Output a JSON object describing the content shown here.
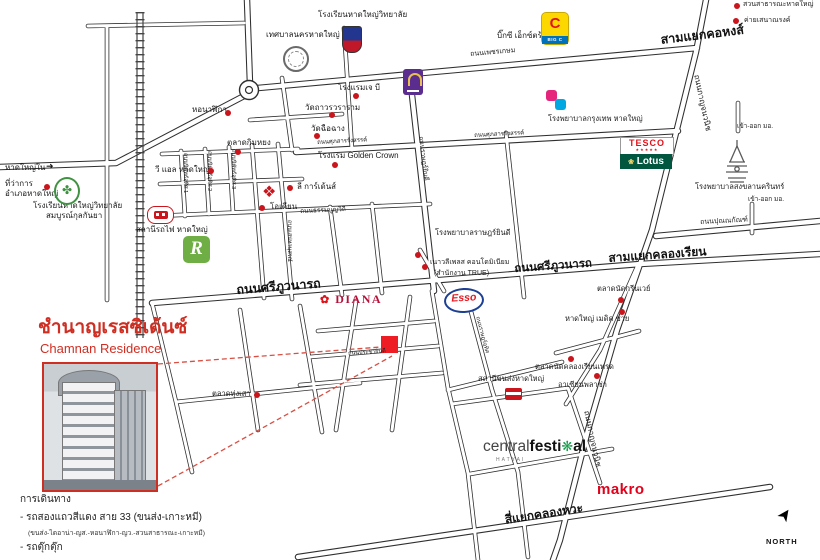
{
  "title": {
    "thai": "ชำนาญเรสซิเด้นซ์",
    "english": "Chamnan Residence"
  },
  "directions": {
    "heading": "การเดินทาง",
    "line1": "- รถสองแถวสีแดง สาย 33 (ขนส่ง-เกาะหมี)",
    "line2": "(ขนส่ง-ไดอาน่า-ญส.-หอนาฬิกา-ญว.-สวนสาธารณะ-เกาะหมี)",
    "line3": "- รถตุ๊กตุ๊ก"
  },
  "junctions": {
    "khohong": "สามแยกคอหงส์",
    "khlongrian": "สามแยกคลองเรียน",
    "khlongwa": "สี่แยกคลองหวะ"
  },
  "roads": {
    "phetkasem": "ถนนเพชรเกษม",
    "kanchanavanich": "ถนนกาญจนวนิช",
    "suphasan": "ถนนศุภสารรังสรรค์",
    "thamnoonvithi": "ถนนธรรมนูญวิถี",
    "sripoowanart": "ถนนศรีภูวนารถ",
    "nipat1": "ถนนนิพัทธ์อุทิศ 1",
    "nipat2": "ถนนนิพัทธ์อุทิศ 2",
    "nipat3": "ถนนนิพัทธ์อุทิศ 3",
    "sanehanusorn": "ถนนเสน่หานุสรณ์",
    "rajyindee": "ถนนราษฎร์ยินดี",
    "punnakan": "ถนนปุณณกัณฑ์",
    "prachayindee": "ถนนประชายินดี",
    "ratuthit": "ถนนราษฎร์อุทิศ",
    "hatyainai": "หาดใหญ่ใน",
    "psu_gate": "เข้า-ออก มอ."
  },
  "pois": {
    "municipality": "เทศบาลนครหาดใหญ่",
    "hatyaiwit_school": "โรงเรียนหาดใหญ่วิทยาลัย",
    "bigc": "บิ๊กซี เอ็กซ์ตร้า",
    "park": "สวนสาธารณะหาดใหญ่",
    "army_camp": "ค่ายเสนาณรงค์",
    "jb_hotel": "โรงแรมเจ บี",
    "wat_thavorn": "วัดถาวรวราราม",
    "wat_chuechang": "วัดฉือฉาง",
    "kimyong_market": "ตลาดกิมหยง",
    "vl_hatyai": "วี แอล หาดใหญ่",
    "district_office_1": "ที่ว่าการ",
    "district_office_2": "อำเภอหาดใหญ่",
    "ysk_school_1": "โรงเรียนหาดใหญ่วิทยาลัย",
    "ysk_school_2": "สมบูรณ์กุลกันยา",
    "clock_tower": "หอนาฬิกา",
    "train_station": "สถานีรถไฟ หาดใหญ่",
    "odean": "โอเดียน",
    "golden_crown": "โรงแรม Golden Crown",
    "lee_gardens": "ลี การ์เด้นส์",
    "bangkok_hospital": "โรงพยาบาลกรุงเทพ หาดใหญ่",
    "rajyindee_hospital": "โรงพยาบาลราษฎร์ยินดี",
    "naovalee_1": "เนาวลีเพลส คอนโดมิเนียม",
    "naovalee_2": "(สำนักงาน TRUE)",
    "psu_hospital": "โรงพยาบาลสงขลานครินทร์",
    "greenway_market": "ตลาดนัดกรีนเวย์",
    "medic_sai": "หาดใหญ่ เมดิค ซาย",
    "khlongrian_market": "ตลาดนัดคลองเรียนเทรด",
    "asian_plaza": "อาเซียนพลาซ่า",
    "bus_terminal": "สถานีขนส่งหาดใหญ่",
    "thungsao_market": "ตลาดทุ่งเสา"
  },
  "logos": {
    "tesco": "TESCO",
    "lotus": "Lotus",
    "esso": "Esso",
    "diana": "DIANA",
    "makro": "makro",
    "central_1": "central",
    "central_2": "festi",
    "central_3": "al",
    "central_sub": "HATYAI",
    "robinson": "R",
    "bigc_bar": "BIG C"
  },
  "compass": {
    "north": "NORTH"
  },
  "colors": {
    "accent_red": "#cf2e23",
    "marker_red": "#ee1c23",
    "dot_red": "#c9151b",
    "dashed_red": "#d94f43",
    "road_dark": "#2f2f2f",
    "esso_blue": "#1b3f94",
    "esso_red": "#e31c24",
    "tesco_red": "#e0121a",
    "lotus_green": "#00563f",
    "makro_red": "#e2001a",
    "central_green": "#169b4a",
    "diana_red": "#b5123a",
    "robinson_green": "#6fae44",
    "bigc_yellow": "#fdd800",
    "bigc_blue": "#0072bc",
    "jb_purple": "#5b2d8e",
    "bkk_pink": "#e5257c",
    "bkk_blue": "#00a7e1",
    "school_green": "#3f9242",
    "crest_blue": "#23368f",
    "crest_red": "#c01828"
  }
}
